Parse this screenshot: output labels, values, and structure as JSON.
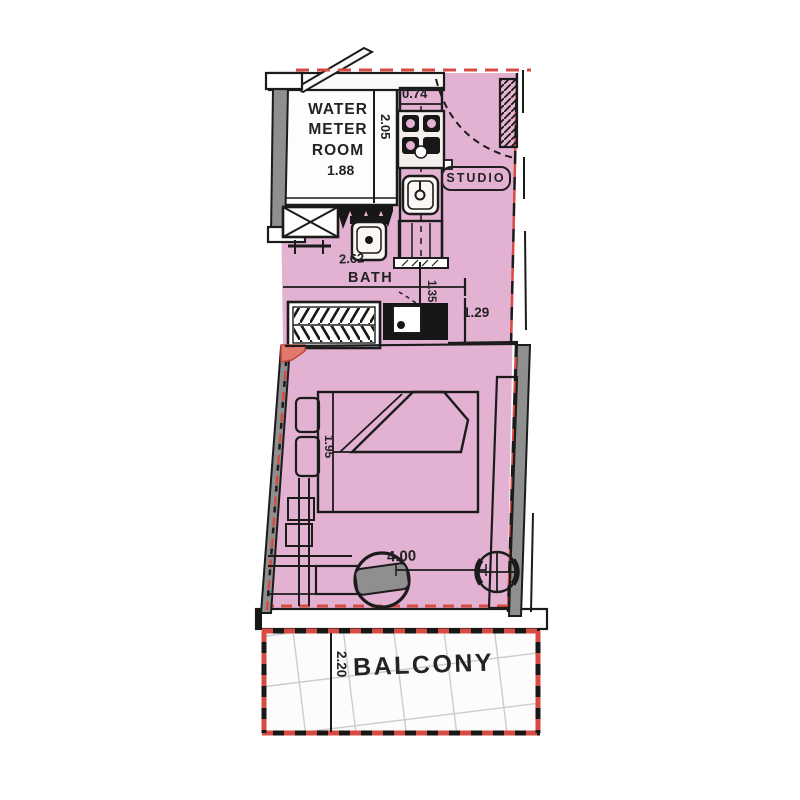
{
  "plan": {
    "type": "studio-apartment-floor-plan",
    "labels": {
      "water_meter_room": "WATER METER ROOM",
      "studio": "STUDIO",
      "bath": "BATH",
      "balcony": "BALCONY"
    },
    "dimensions": {
      "water_meter_width": "1.88",
      "water_meter_depth": "2.05",
      "kitchen_entry": "0.74",
      "bath_width": "2.62",
      "bath_passage": "1.35",
      "wall_niche": "1.29",
      "bed_length": "1.95",
      "room_width": "4.00",
      "balcony_depth": "2.20"
    },
    "colors": {
      "floor_fill": "#e3b2d2",
      "boundary_red": "#d84b42",
      "wall_gray": "#8f8f8f",
      "line_black": "#1b1b1b",
      "tile_gray": "#cccccc",
      "background": "#ffffff"
    }
  }
}
